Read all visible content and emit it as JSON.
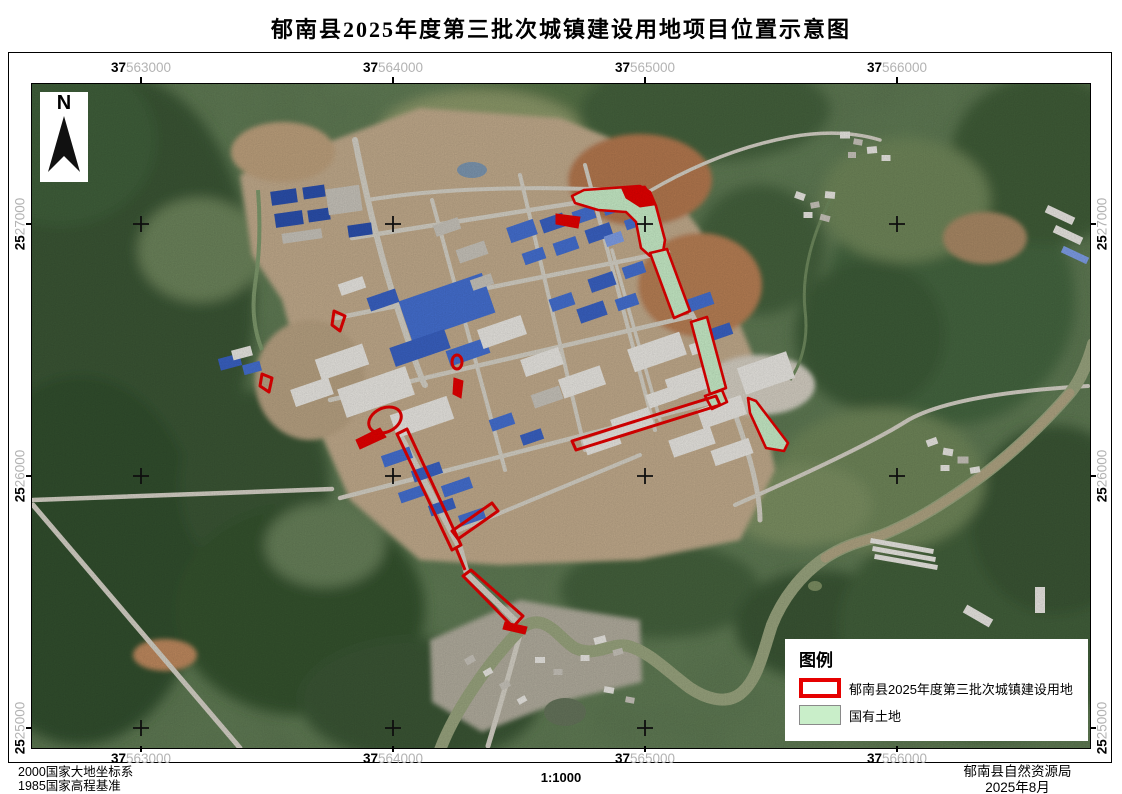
{
  "title": "郁南县2025年度第三批次城镇建设用地项目位置示意图",
  "north_label": "N",
  "grid": {
    "x": [
      {
        "prefix": "37",
        "rest": "563000"
      },
      {
        "prefix": "37",
        "rest": "564000"
      },
      {
        "prefix": "37",
        "rest": "565000"
      },
      {
        "prefix": "37",
        "rest": "566000"
      }
    ],
    "y": [
      {
        "prefix": "25",
        "rest": "27000"
      },
      {
        "prefix": "25",
        "rest": "26000"
      },
      {
        "prefix": "25",
        "rest": "25000"
      }
    ]
  },
  "legend": {
    "title": "图例",
    "items": [
      {
        "label": "郁南县2025年度第三批次城镇建设用地",
        "swatch": "red-outline"
      },
      {
        "label": "国有土地",
        "swatch": "green-fill"
      }
    ]
  },
  "footer": {
    "datum_line1": "2000国家大地坐标系",
    "datum_line2": "1985国家高程基准",
    "scale": "1:1000",
    "agency": "郁南县自然资源局",
    "date": "2025年8月"
  },
  "colors": {
    "project_red": "#e60000",
    "state_land_green": "#c9eec9"
  }
}
